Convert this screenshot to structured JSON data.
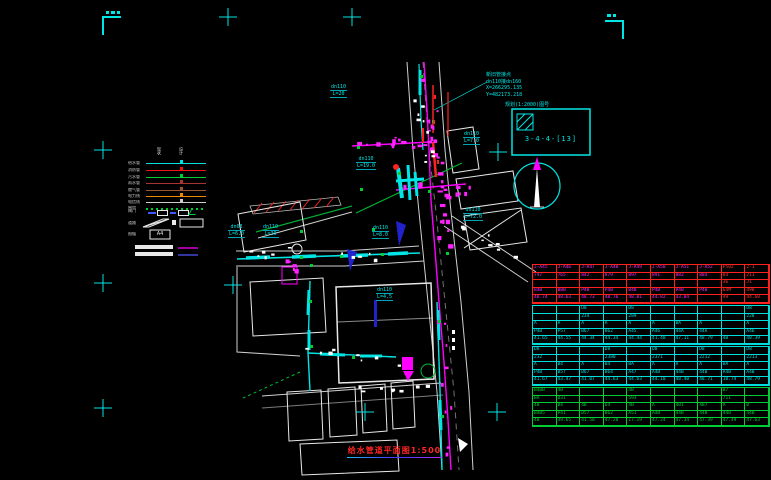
{
  "title": {
    "text": "给水管道平面图1:500"
  },
  "sheet": {
    "note": "规划(1:2000)图号",
    "code": "3-4-4-[13]"
  },
  "map": {
    "junction_note": {
      "title": "新旧管接点",
      "pipe": "dn110接dn160",
      "x": "X=266295.135",
      "y": "Y=482173.218"
    },
    "pipe_labels": [
      {
        "size": "dn110",
        "length": "L=20"
      },
      {
        "size": "dn110",
        "length": "L=7.0"
      },
      {
        "size": "dn110",
        "length": "L=72.0"
      },
      {
        "size": "dn63",
        "length": "L=6.0"
      },
      {
        "size": "dn110",
        "length": "L=30"
      },
      {
        "size": "dn110",
        "length": "L=8.0"
      },
      {
        "size": "dn110",
        "length": "L=19.0"
      },
      {
        "size": "dn110",
        "length": "L=4.5"
      }
    ]
  },
  "legend": {
    "headers": [
      "现状",
      "设计"
    ],
    "a4_label": "A4",
    "items": [
      {
        "label": "给水管",
        "color": "#00e0e0",
        "style": "line"
      },
      {
        "label": "消防管",
        "color": "#ee1111",
        "style": "line"
      },
      {
        "label": "污水管",
        "color": "#00cc33",
        "style": "line"
      },
      {
        "label": "雨水管",
        "color": "#aa3333",
        "style": "line"
      },
      {
        "label": "燃气管",
        "color": "#995533",
        "style": "line"
      },
      {
        "label": "电力线",
        "color": "#ee8800",
        "style": "line"
      },
      {
        "label": "电信线",
        "color": "#cccccc",
        "style": "line"
      },
      {
        "label": "围墙",
        "color": "#00cc33",
        "style": "dotted"
      },
      {
        "label": "阀门",
        "color": "#4455ff",
        "style": "boxes"
      },
      {
        "label": "道路",
        "color": "#ffffff",
        "style": "parallelogram"
      },
      {
        "label": "图幅",
        "color": "#ffffff",
        "style": "a4"
      },
      {
        "label": "现状管",
        "color": "#ff00ff",
        "style": "bar"
      },
      {
        "label": "设计管",
        "color": "#5555ff",
        "style": "bar"
      }
    ]
  },
  "table": {
    "sections": [
      {
        "border": "#ff2020",
        "text": "#ff22ff",
        "red_last_cols": 2,
        "rows": [
          [
            "J-A45",
            "J-A46",
            "J-A47",
            "J-A48",
            "J-A49",
            "J-A50",
            "J-A51",
            "J-A52",
            "P502",
            "2-1"
          ],
          [
            "747",
            "765",
            "842",
            "879",
            "897",
            "891",
            "882",
            "884",
            "84",
            "211"
          ],
          [
            "",
            "",
            "",
            "",
            "",
            "",
            "",
            "",
            "36",
            "J1"
          ],
          [
            "B4B",
            "B8B",
            "P4B",
            "P4B",
            "B4B",
            "P4B",
            "P4B",
            "P4B",
            "64M",
            "49B"
          ],
          [
            "48.74",
            "48.63",
            "48.73",
            "48.76",
            "48.81",
            "44.82",
            "43.04",
            "",
            "49",
            "44.60"
          ]
        ]
      },
      {
        "border": "#00dddd",
        "text": "#00dddd",
        "red_last_cols": 0,
        "rows": [
          [
            "",
            "",
            "D8",
            "",
            "D8",
            "",
            "",
            "",
            "",
            "D8"
          ],
          [
            "",
            "",
            "234",
            "",
            "289",
            "",
            "",
            "",
            "",
            "228"
          ],
          [
            "A",
            "A",
            "A",
            "A",
            "A",
            "A",
            "BA",
            "A",
            "",
            "A"
          ],
          [
            "P4B",
            "P57",
            "B67",
            "B62",
            "A45",
            "A46",
            "44A",
            "44A",
            "",
            "A46"
          ],
          [
            "41.65",
            "44.55",
            "44.34",
            "44.34",
            "44.44",
            "41.48",
            "47.11",
            "48.79",
            "4B",
            "48.39"
          ]
        ]
      },
      {
        "border": "#00dddd",
        "text": "#00dddd",
        "red_last_cols": 0,
        "rows": [
          [
            "D8",
            "",
            "",
            "D8",
            "",
            "D8",
            "",
            "D8",
            "",
            "D8"
          ],
          [
            "232",
            "",
            "",
            "2380",
            "",
            "2371",
            "",
            "2212",
            "",
            "2213"
          ],
          [
            "A",
            "B4",
            "A",
            "B4",
            "BA",
            "A",
            "A",
            "A",
            "BA",
            "A"
          ],
          [
            "P4B",
            "B57",
            "B67",
            "B64",
            "A47",
            "A4B",
            "44B",
            "44B",
            "A4B",
            "A4B"
          ],
          [
            "41.67",
            "43.47",
            "41.07",
            "44.63",
            "44.63",
            "44.10",
            "48.40",
            "48.71",
            "18.74",
            "48.79"
          ]
        ]
      },
      {
        "border": "#00cc33",
        "text": "#00cc33",
        "red_last_cols": 0,
        "rows": [
          [
            "B4BB",
            "4B",
            "",
            "",
            "4B",
            "",
            "",
            "",
            "B7",
            ""
          ],
          [
            "BA",
            "D31",
            "",
            "",
            "593",
            "",
            "",
            "",
            "711",
            ""
          ],
          [
            "4B",
            "B4",
            "4B",
            "D4",
            "4B",
            "A",
            "4B1",
            "4B7",
            "A",
            "B"
          ],
          [
            "B4B5",
            "P41",
            "B57",
            "B62",
            "A51",
            "A4B",
            "44B",
            "44B",
            "44B",
            "44B"
          ],
          [
            "4B",
            "49.65",
            "41.58",
            "47.28",
            "17.19",
            "47.24",
            "47.34",
            "47.39",
            "47.49",
            "47.63"
          ]
        ]
      }
    ]
  }
}
